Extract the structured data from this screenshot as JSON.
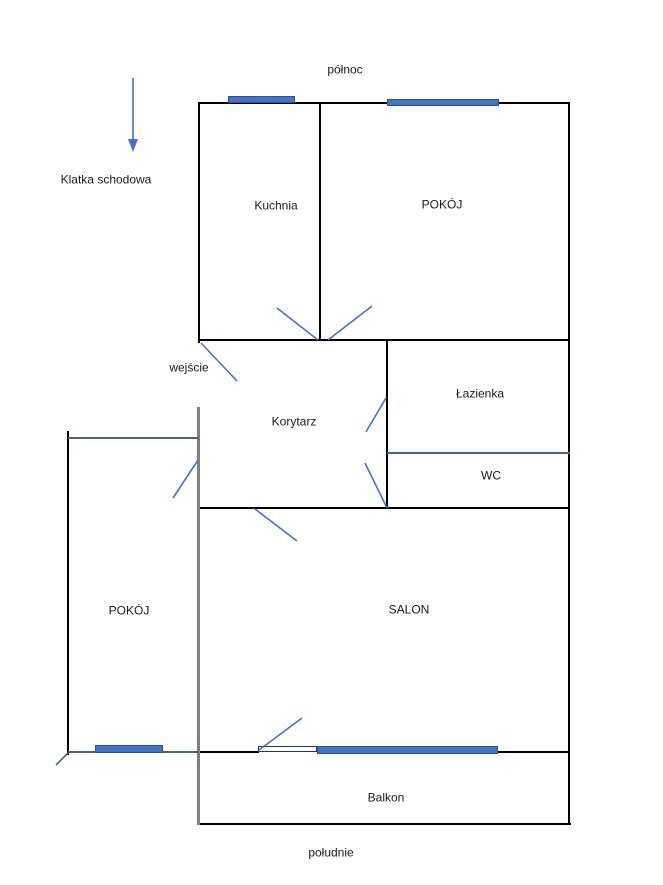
{
  "compass": {
    "north": "północ",
    "south": "południe"
  },
  "annotations": {
    "staircase": "Klatka schodowa",
    "entrance": "wejście"
  },
  "rooms": {
    "kuchnia": {
      "label": "Kuchnia"
    },
    "pokoj_north": {
      "label": "POKÓJ"
    },
    "lazienka": {
      "label": "Łazienka"
    },
    "wc": {
      "label": "WC"
    },
    "korytarz": {
      "label": "Korytarz"
    },
    "pokoj_west": {
      "label": "POKÓJ"
    },
    "salon": {
      "label": "SALON"
    },
    "balkon": {
      "label": "Balkon"
    }
  },
  "colors": {
    "wall": "#000000",
    "wall_gray": "#808080",
    "partition_line": "#46648c",
    "accent_blue": "#4472c4",
    "window_border": "#2f528f",
    "text": "#1a1a1a",
    "background": "#ffffff"
  }
}
